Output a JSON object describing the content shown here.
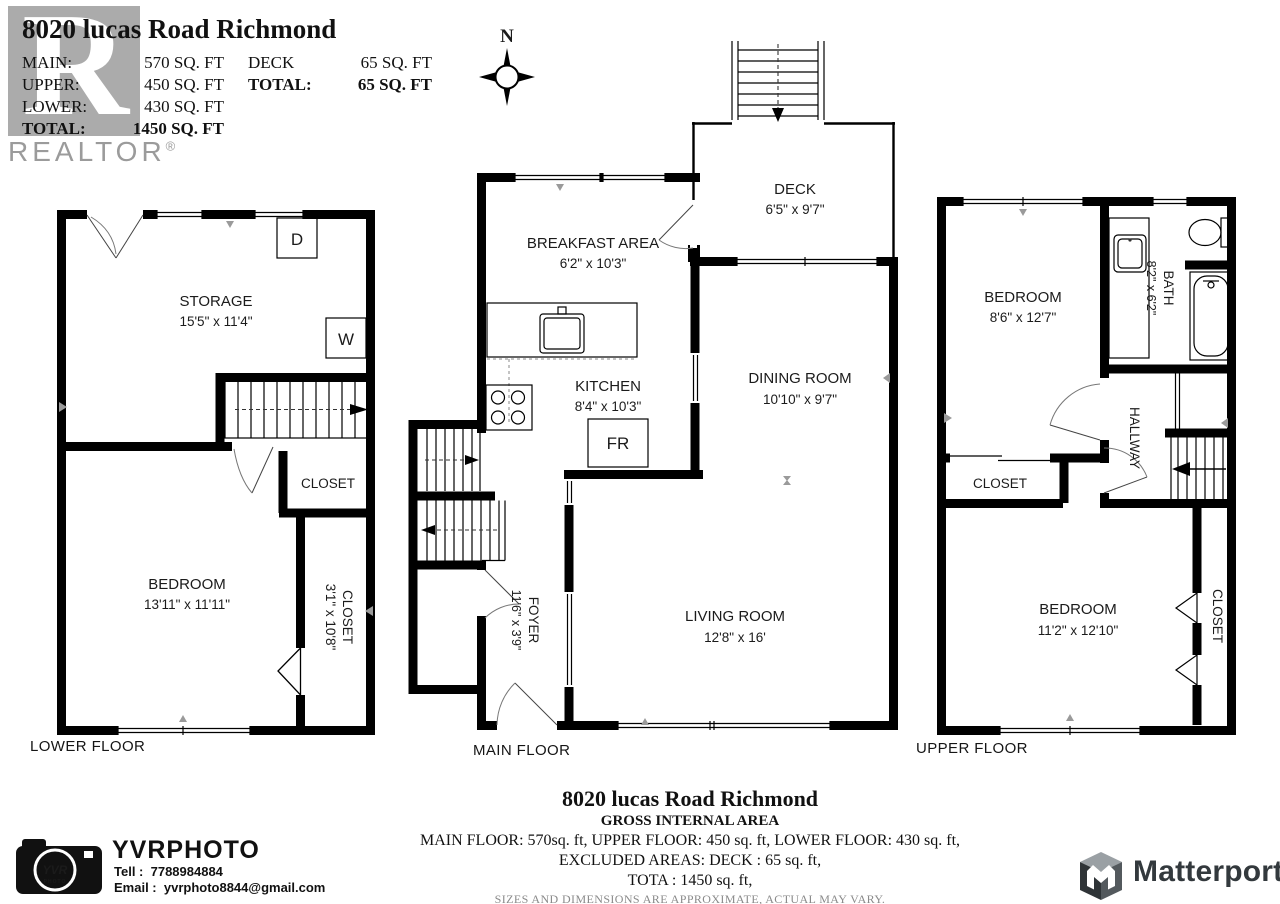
{
  "header": {
    "title": "8020 lucas Road Richmond",
    "realtor_r": "R",
    "realtor_wordmark": "REALTOR",
    "registered": "®",
    "col1": [
      {
        "label": "MAIN:",
        "value": "570 SQ. FT"
      },
      {
        "label": "UPPER:",
        "value": "450 SQ. FT"
      },
      {
        "label": "LOWER:",
        "value": "430 SQ. FT"
      },
      {
        "label": "TOTAL:",
        "value": "1450 SQ. FT"
      }
    ],
    "col2": [
      {
        "label": "DECK",
        "value": "65 SQ. FT"
      },
      {
        "label": "TOTAL:",
        "value": "65 SQ. FT"
      }
    ]
  },
  "compass": {
    "north": "N"
  },
  "lower_floor": {
    "floor_label": "LOWER FLOOR",
    "storage_name": "STORAGE",
    "storage_dims": "15'5\" x 11'4\"",
    "bedroom_name": "BEDROOM",
    "bedroom_dims": "13'11\" x 11'11\"",
    "closet_name": "CLOSET",
    "closet2_name": "CLOSET",
    "closet2_dims": "3'1\" x 10'8\"",
    "dryer": "D",
    "washer": "W"
  },
  "main_floor": {
    "floor_label": "MAIN FLOOR",
    "deck_name": "DECK",
    "deck_dims": "6'5\" x 9'7\"",
    "breakfast_name": "BREAKFAST AREA",
    "breakfast_dims": "6'2\" x 10'3\"",
    "kitchen_name": "KITCHEN",
    "kitchen_dims": "8'4\" x 10'3\"",
    "dining_name": "DINING ROOM",
    "dining_dims": "10'10\" x 9'7\"",
    "living_name": "LIVING ROOM",
    "living_dims": "12'8\" x 16'",
    "foyer_name": "FOYER",
    "foyer_dims": "11'6\" x 3'9\"",
    "fridge": "FR"
  },
  "upper_floor": {
    "floor_label": "UPPER FLOOR",
    "bedroom1_name": "BEDROOM",
    "bedroom1_dims": "8'6\" x 12'7\"",
    "bath_name": "BATH",
    "bath_dims": "8'2\" x 6'2\"",
    "hallway": "HALLWAY",
    "closet1": "CLOSET",
    "bedroom2_name": "BEDROOM",
    "bedroom2_dims": "11'2\" x 12'10\"",
    "closet2": "CLOSET"
  },
  "footer": {
    "title": "8020 lucas Road Richmond",
    "subtitle": "GROSS INTERNAL AREA",
    "line1": "MAIN FLOOR: 570sq. ft, UPPER FLOOR: 450 sq. ft, LOWER FLOOR: 430 sq. ft,",
    "line2": "EXCLUDED AREAS: DECK : 65 sq. ft,",
    "line3": "TOTA : 1450  sq. ft,",
    "disclaimer": "SIZES AND DIMENSIONS ARE APPROXIMATE, ACTUAL MAY VARY."
  },
  "yvr": {
    "brand": "YVRPHOTO",
    "tel_label": "Tell :",
    "tel": "7788984884",
    "email_label": "Email :",
    "email": "yvrphoto8844@gmail.com",
    "lens_top": "YVR",
    "lens_bottom": "PHOTO"
  },
  "matterport": {
    "brand": "Matterport"
  },
  "colors": {
    "wall": "#000000",
    "accent_blue": "#57b6e8",
    "logo_gray": "#ababab",
    "matterport_dark": "#33393d"
  }
}
